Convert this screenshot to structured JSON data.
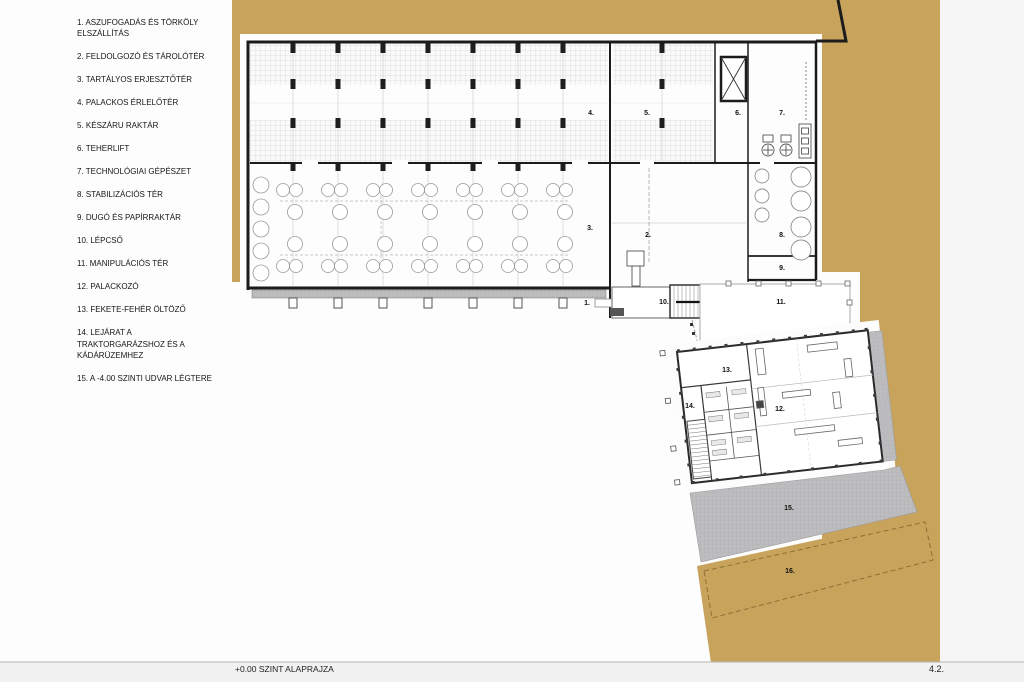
{
  "legend": {
    "items": [
      "1. ASZUFOGADÁS ÉS TÖRKÖLY\nELSZÁLLÍTÁS",
      "2. FELDOLGOZÓ ÉS TÁROLÓTÉR",
      "3. TARTÁLYOS ERJESZTŐTÉR",
      "4. PALACKOS ÉRLELŐTÉR",
      "5. KÉSZÁRU RAKTÁR",
      "6. TEHERLIFT",
      "7. TECHNOLÓGIAI GÉPÉSZET",
      "8. STABILIZÁCIÓS TÉR",
      "9. DUGÓ ÉS PAPÍRRAKTÁR",
      "10. LÉPCSŐ",
      "11. MANIPULÁCIÓS TÉR",
      "12. PALACKOZÓ",
      "13. FEKETE-FEHÉR ÖLTÖZŐ",
      "14. LEJÁRAT A\nTRAKTORGARÁZSHOZ ÉS A\nKÁDÁRÜZEMHEZ",
      "15. A -4.00 SZINTI UDVAR LÉGTERE"
    ]
  },
  "plan": {
    "room_labels": [
      {
        "text": "1."
      },
      {
        "text": "2."
      },
      {
        "text": "3."
      },
      {
        "text": "4."
      },
      {
        "text": "5."
      },
      {
        "text": "6."
      },
      {
        "text": "7."
      },
      {
        "text": "8."
      },
      {
        "text": "9."
      },
      {
        "text": "10."
      },
      {
        "text": "11."
      },
      {
        "text": "12."
      },
      {
        "text": "13."
      },
      {
        "text": "14."
      },
      {
        "text": "15."
      },
      {
        "text": "16."
      }
    ],
    "colors": {
      "site_tan": "#c7a35c",
      "courtyard_gray": "#bdbdbf",
      "wall": "#1b1b1b"
    }
  },
  "footer": {
    "title": "+0.00 SZINT ALAPRAJZA",
    "sheet_number": "4.2."
  }
}
